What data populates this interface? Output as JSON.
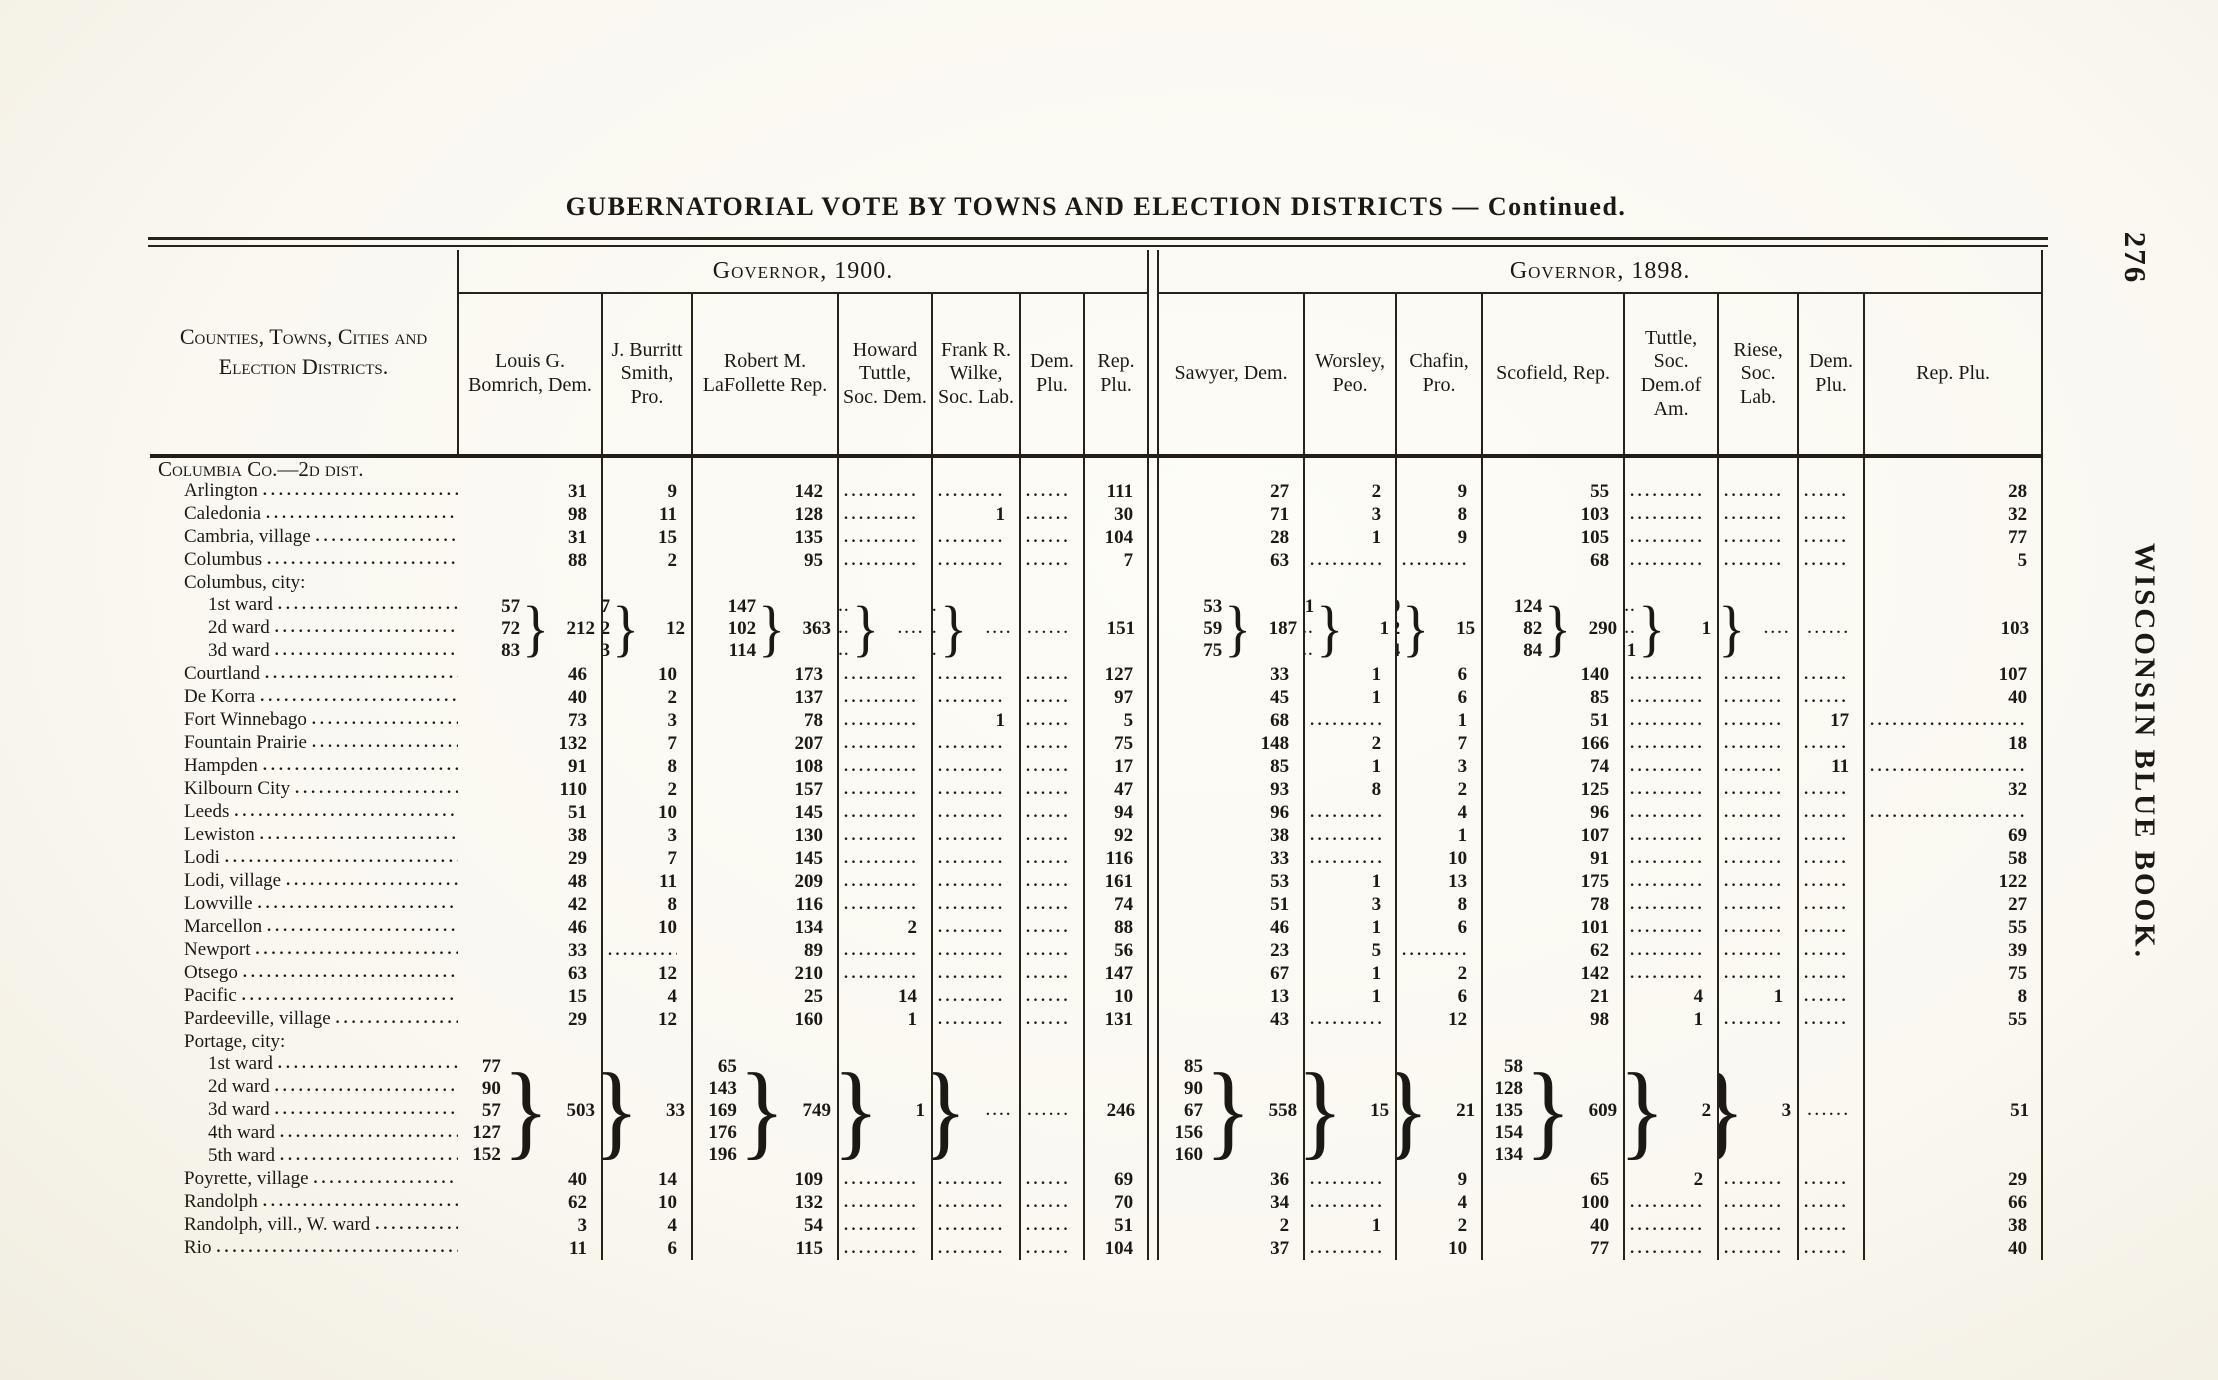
{
  "page": {
    "title": "GUBERNATORIAL VOTE BY TOWNS AND ELECTION DISTRICTS — Continued.",
    "page_number": "276",
    "margin_text": "WISCONSIN BLUE BOOK."
  },
  "table": {
    "row_header": "Counties, Towns, Cities and Election Districts.",
    "groups": [
      {
        "label": "Governor, 1900.",
        "columns": [
          "Louis G. Bomrich, Dem.",
          "J. Burritt Smith, Pro.",
          "Robert M. LaFollette Rep.",
          "Howard Tuttle, Soc. Dem.",
          "Frank R. Wilke, Soc. Lab.",
          "Dem. Plu.",
          "Rep. Plu."
        ]
      },
      {
        "label": "Governor, 1898.",
        "columns": [
          "Sawyer, Dem.",
          "Worsley, Peo.",
          "Chafin, Pro.",
          "Scofield, Rep.",
          "Tuttle, Soc. Dem.of Am.",
          "Riese, Soc. Lab.",
          "Dem. Plu.",
          "Rep. Plu."
        ]
      }
    ],
    "rows": [
      {
        "t": "section",
        "label": "Columbia Co.—2d dist."
      },
      {
        "t": "d",
        "label": "Arlington",
        "v": [
          "31",
          "9",
          "142",
          "",
          "",
          "",
          "111",
          "27",
          "2",
          "9",
          "55",
          "",
          "",
          "",
          "28"
        ]
      },
      {
        "t": "d",
        "label": "Caledonia",
        "v": [
          "98",
          "11",
          "128",
          "",
          "1",
          "",
          "30",
          "71",
          "3",
          "8",
          "103",
          "",
          "",
          "",
          "32"
        ]
      },
      {
        "t": "d",
        "label": "Cambria, village",
        "v": [
          "31",
          "15",
          "135",
          "",
          "",
          "",
          "104",
          "28",
          "1",
          "9",
          "105",
          "",
          "",
          "",
          "77"
        ]
      },
      {
        "t": "d",
        "label": "Columbus",
        "v": [
          "88",
          "2",
          "95",
          "",
          "",
          "",
          "7",
          "63",
          "",
          "",
          "68",
          "",
          "",
          "",
          "5"
        ]
      },
      {
        "t": "h",
        "label": "Columbus, city:"
      },
      {
        "t": "g",
        "wards": [
          "1st ward",
          "2d ward",
          "3d ward"
        ],
        "cols": [
          {
            "w": [
              "57",
              "72",
              "83"
            ],
            "x": "212"
          },
          {
            "w": [
              "7",
              "2",
              "3"
            ],
            "x": "12"
          },
          {
            "w": [
              "147",
              "102",
              "114"
            ],
            "x": "363"
          },
          {
            "w": [
              "",
              "",
              ""
            ],
            "x": ""
          },
          {
            "w": [
              "",
              "",
              ""
            ],
            "x": ""
          },
          {
            "s": ""
          },
          {
            "s": "151"
          },
          {
            "w": [
              "53",
              "59",
              "75"
            ],
            "x": "187"
          },
          {
            "w": [
              "1",
              "",
              ""
            ],
            "x": "1"
          },
          {
            "w": [
              "9",
              "2",
              "4"
            ],
            "x": "15"
          },
          {
            "w": [
              "124",
              "82",
              "84"
            ],
            "x": "290"
          },
          {
            "w": [
              "",
              "",
              "1"
            ],
            "x": "1"
          },
          {
            "w": [
              "",
              "",
              ""
            ],
            "x": ""
          },
          {
            "s": ""
          },
          {
            "s": "103"
          }
        ]
      },
      {
        "t": "d",
        "label": "Courtland",
        "v": [
          "46",
          "10",
          "173",
          "",
          "",
          "",
          "127",
          "33",
          "1",
          "6",
          "140",
          "",
          "",
          "",
          "107"
        ]
      },
      {
        "t": "d",
        "label": "De Korra",
        "v": [
          "40",
          "2",
          "137",
          "",
          "",
          "",
          "97",
          "45",
          "1",
          "6",
          "85",
          "",
          "",
          "",
          "40"
        ]
      },
      {
        "t": "d",
        "label": "Fort Winnebago",
        "v": [
          "73",
          "3",
          "78",
          "",
          "1",
          "",
          "5",
          "68",
          "",
          "1",
          "51",
          "",
          "",
          "17",
          ""
        ]
      },
      {
        "t": "d",
        "label": "Fountain Prairie",
        "v": [
          "132",
          "7",
          "207",
          "",
          "",
          "",
          "75",
          "148",
          "2",
          "7",
          "166",
          "",
          "",
          "",
          "18"
        ]
      },
      {
        "t": "d",
        "label": "Hampden",
        "v": [
          "91",
          "8",
          "108",
          "",
          "",
          "",
          "17",
          "85",
          "1",
          "3",
          "74",
          "",
          "",
          "11",
          ""
        ]
      },
      {
        "t": "d",
        "label": "Kilbourn City",
        "v": [
          "110",
          "2",
          "157",
          "",
          "",
          "",
          "47",
          "93",
          "8",
          "2",
          "125",
          "",
          "",
          "",
          "32"
        ]
      },
      {
        "t": "d",
        "label": "Leeds",
        "v": [
          "51",
          "10",
          "145",
          "",
          "",
          "",
          "94",
          "96",
          "",
          "4",
          "96",
          "",
          "",
          "",
          ""
        ]
      },
      {
        "t": "d",
        "label": "Lewiston",
        "v": [
          "38",
          "3",
          "130",
          "",
          "",
          "",
          "92",
          "38",
          "",
          "1",
          "107",
          "",
          "",
          "",
          "69"
        ]
      },
      {
        "t": "d",
        "label": "Lodi",
        "v": [
          "29",
          "7",
          "145",
          "",
          "",
          "",
          "116",
          "33",
          "",
          "10",
          "91",
          "",
          "",
          "",
          "58"
        ]
      },
      {
        "t": "d",
        "label": "Lodi, village",
        "v": [
          "48",
          "11",
          "209",
          "",
          "",
          "",
          "161",
          "53",
          "1",
          "13",
          "175",
          "",
          "",
          "",
          "122"
        ]
      },
      {
        "t": "d",
        "label": "Lowville",
        "v": [
          "42",
          "8",
          "116",
          "",
          "",
          "",
          "74",
          "51",
          "3",
          "8",
          "78",
          "",
          "",
          "",
          "27"
        ]
      },
      {
        "t": "d",
        "label": "Marcellon",
        "v": [
          "46",
          "10",
          "134",
          "2",
          "",
          "",
          "88",
          "46",
          "1",
          "6",
          "101",
          "",
          "",
          "",
          "55"
        ]
      },
      {
        "t": "d",
        "label": "Newport",
        "v": [
          "33",
          "",
          "89",
          "",
          "",
          "",
          "56",
          "23",
          "5",
          "",
          "62",
          "",
          "",
          "",
          "39"
        ]
      },
      {
        "t": "d",
        "label": "Otsego",
        "v": [
          "63",
          "12",
          "210",
          "",
          "",
          "",
          "147",
          "67",
          "1",
          "2",
          "142",
          "",
          "",
          "",
          "75"
        ]
      },
      {
        "t": "d",
        "label": "Pacific",
        "v": [
          "15",
          "4",
          "25",
          "14",
          "",
          "",
          "10",
          "13",
          "1",
          "6",
          "21",
          "4",
          "1",
          "",
          "8"
        ]
      },
      {
        "t": "d",
        "label": "Pardeeville, village",
        "v": [
          "29",
          "12",
          "160",
          "1",
          "",
          "",
          "131",
          "43",
          "",
          "12",
          "98",
          "1",
          "",
          "",
          "55"
        ]
      },
      {
        "t": "h",
        "label": "Portage, city:"
      },
      {
        "t": "g",
        "wards": [
          "1st ward",
          "2d ward",
          "3d ward",
          "4th ward",
          "5th ward"
        ],
        "cols": [
          {
            "w": [
              "77",
              "90",
              "57",
              "127",
              "152"
            ],
            "x": "503"
          },
          {
            "w": [
              "3",
              "11",
              "7",
              "2",
              "10"
            ],
            "x": "33"
          },
          {
            "w": [
              "65",
              "143",
              "169",
              "176",
              "196"
            ],
            "x": "749"
          },
          {
            "w": [
              "",
              "",
              "1",
              "",
              ""
            ],
            "x": "1"
          },
          {
            "w": [
              "",
              "",
              "",
              "",
              ""
            ],
            "x": ""
          },
          {
            "s": ""
          },
          {
            "s": "246"
          },
          {
            "w": [
              "85",
              "90",
              "67",
              "156",
              "160"
            ],
            "x": "558"
          },
          {
            "w": [
              "2",
              "3",
              "1",
              "3",
              "6"
            ],
            "x": "15"
          },
          {
            "w": [
              "",
              "10",
              "7",
              "1",
              "3"
            ],
            "x": "21"
          },
          {
            "w": [
              "58",
              "128",
              "135",
              "154",
              "134"
            ],
            "x": "609"
          },
          {
            "w": [
              "1",
              "",
              "",
              "1",
              ""
            ],
            "x": "2"
          },
          {
            "w": [
              "",
              "2",
              "",
              "1",
              ""
            ],
            "x": "3"
          },
          {
            "s": ""
          },
          {
            "s": "51"
          }
        ]
      },
      {
        "t": "d",
        "label": "Poyrette, village",
        "v": [
          "40",
          "14",
          "109",
          "",
          "",
          "",
          "69",
          "36",
          "",
          "9",
          "65",
          "2",
          "",
          "",
          "29"
        ]
      },
      {
        "t": "d",
        "label": "Randolph",
        "v": [
          "62",
          "10",
          "132",
          "",
          "",
          "",
          "70",
          "34",
          "",
          "4",
          "100",
          "",
          "",
          "",
          "66"
        ]
      },
      {
        "t": "d",
        "label": "Randolph, vill., W. ward",
        "v": [
          "3",
          "4",
          "54",
          "",
          "",
          "",
          "51",
          "2",
          "1",
          "2",
          "40",
          "",
          "",
          "",
          "38"
        ]
      },
      {
        "t": "d",
        "label": "Rio",
        "v": [
          "11",
          "6",
          "115",
          "",
          "",
          "",
          "104",
          "37",
          "",
          "10",
          "77",
          "",
          "",
          "",
          "40"
        ]
      }
    ]
  }
}
